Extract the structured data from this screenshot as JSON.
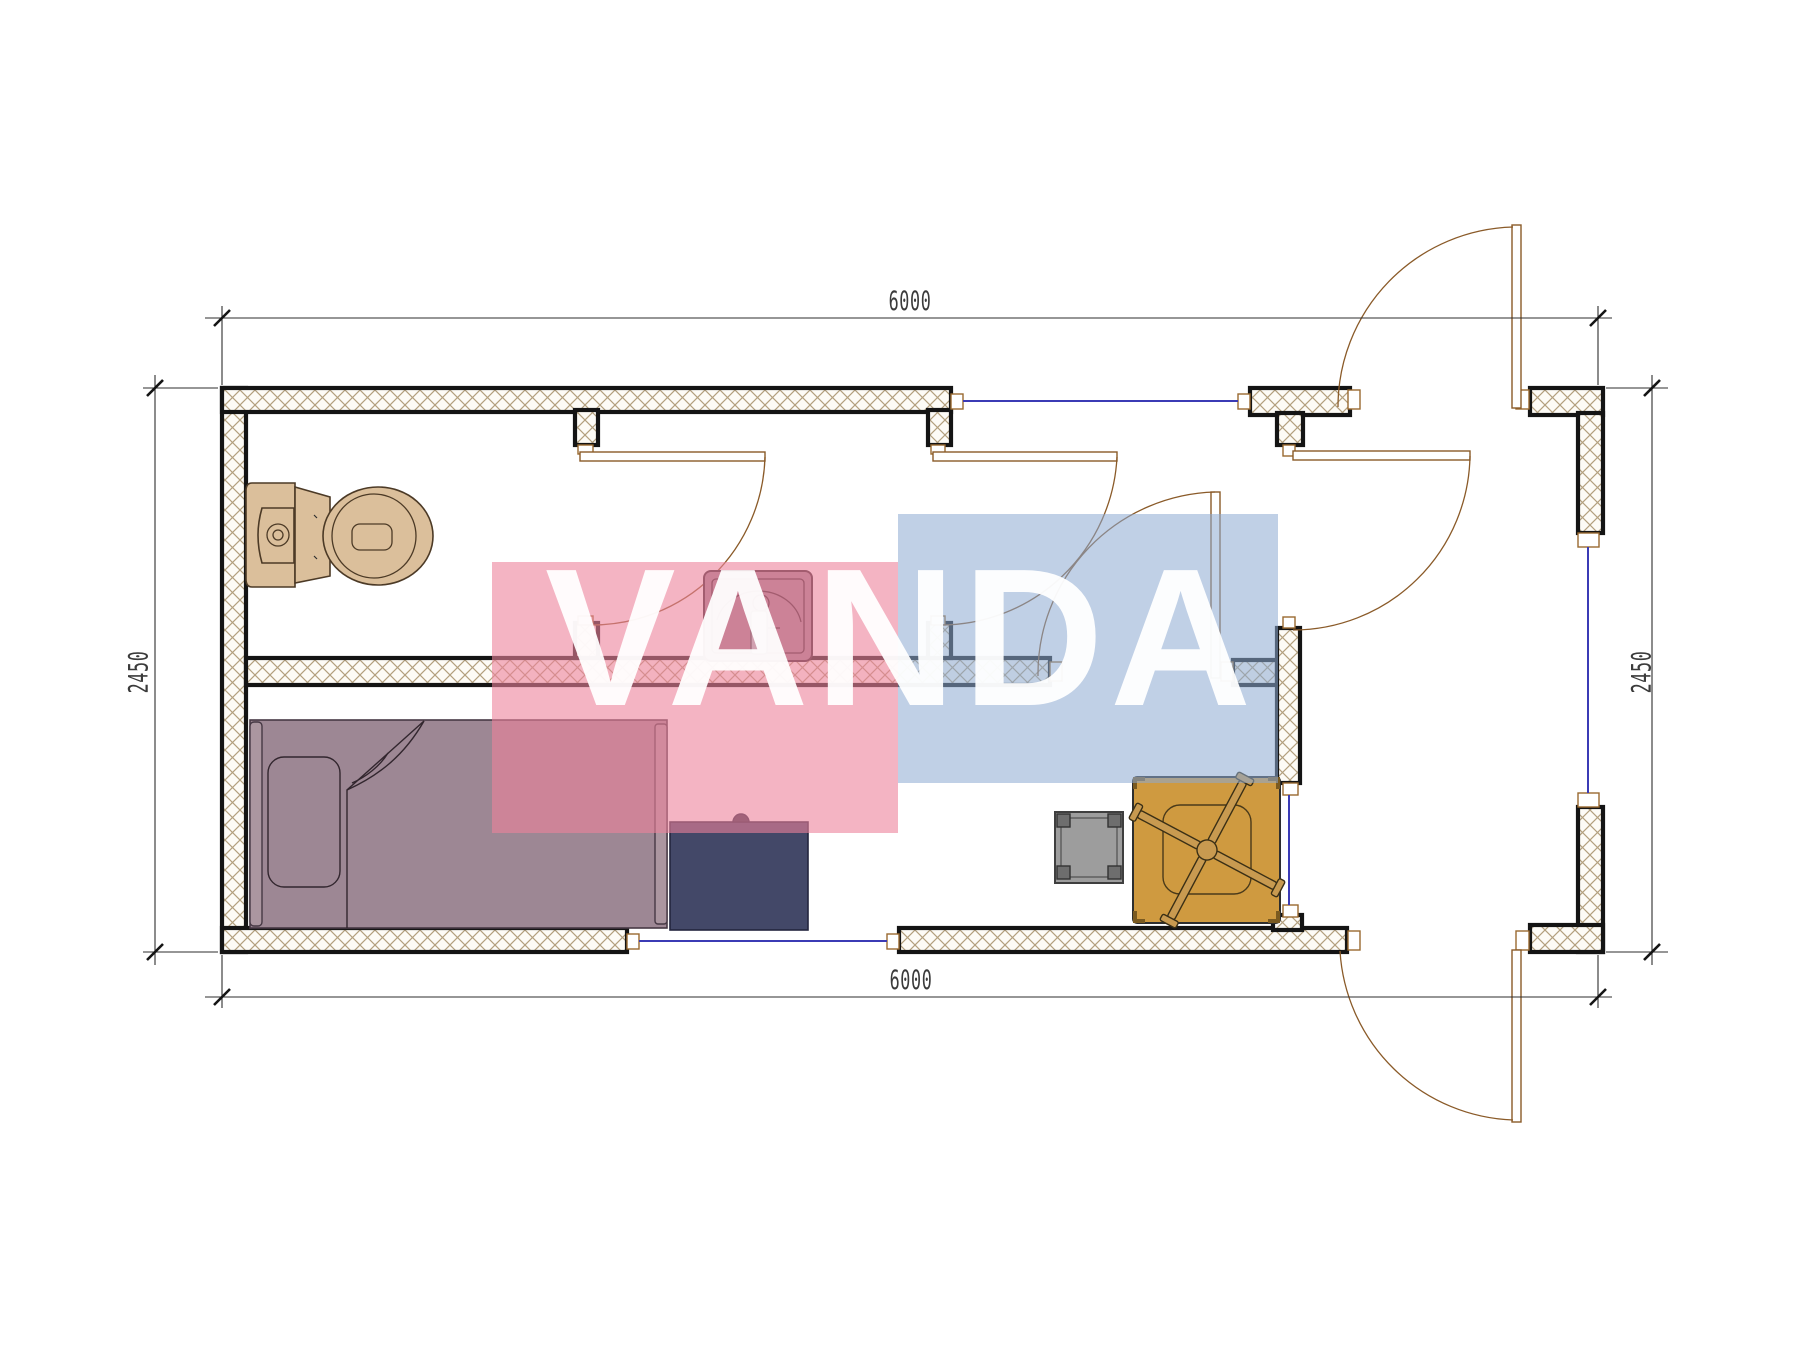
{
  "drawing": {
    "kind": "architectural floor plan",
    "description": "Top view plan of a 6000x2450 modular container house with WC, shower room, hallway, living room and entry porch"
  },
  "dimensions": {
    "top": "6000",
    "bottom": "6000",
    "left": "2450",
    "right": "2450"
  },
  "watermark": {
    "text": "VANDA"
  },
  "symbols": [
    "toilet-symbol",
    "sink-symbol",
    "bed-symbol",
    "desk-symbol",
    "stool-symbol",
    "table-with-chair-symbol",
    "door-swing",
    "window-glazing"
  ],
  "colors": {
    "wall_outline": "#141414",
    "hatch_line": "#b3a07e",
    "door_leaf": "#8a5a28",
    "door_frame": "#9a6a30",
    "glazing": "#3b3bb5",
    "dim_line": "#2e2e2e",
    "dim_text": "#3b3b3b",
    "toilet": "#dbbf9b",
    "sink_body": "#9b8292",
    "sink_teal": "#a9cfd0",
    "bed": "#9d8794",
    "bed_light": "#ab96a0",
    "desk": "#434868",
    "stool": "#9d9d9d",
    "table": "#cf9a40",
    "chair": "#c89a50",
    "wm_pink": "rgba(236,130,155,0.60)",
    "wm_blue": "rgba(140,170,210,0.55)"
  }
}
